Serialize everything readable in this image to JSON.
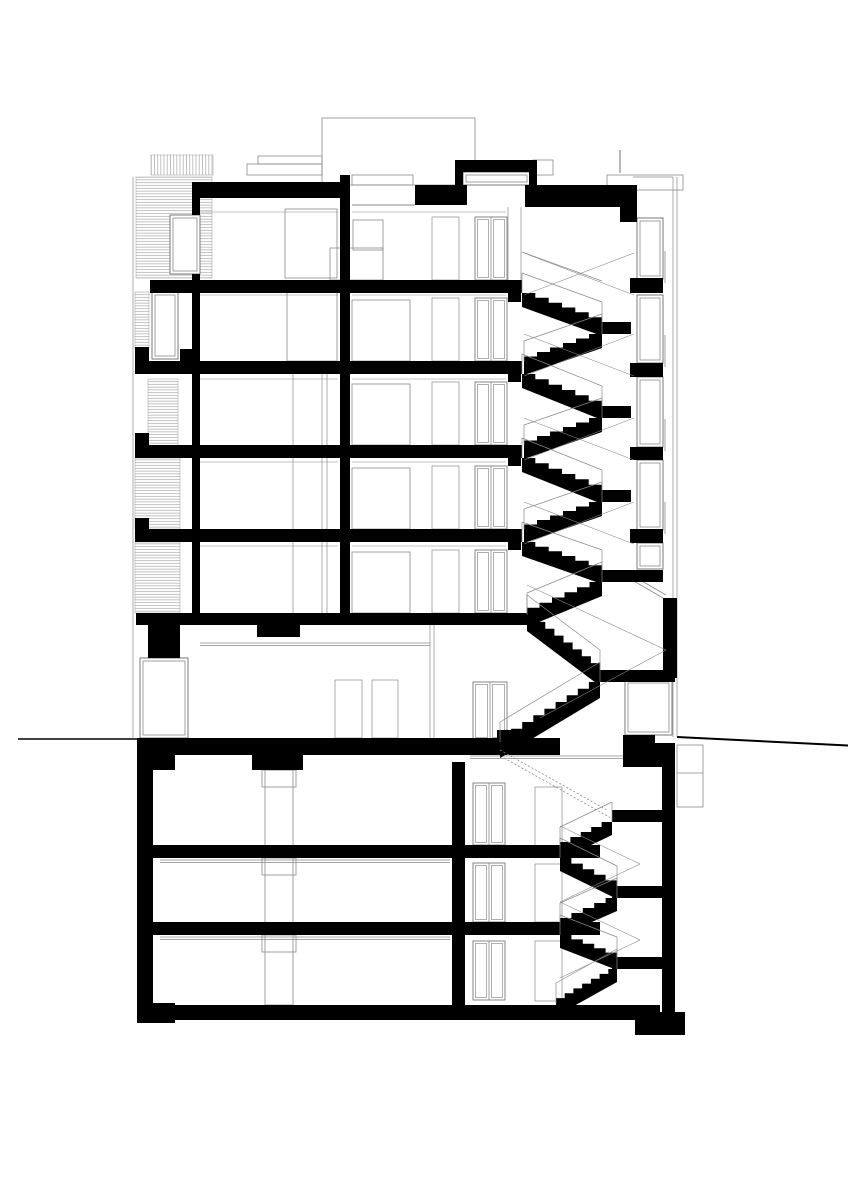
{
  "document": {
    "kind": "architectural-section-drawing",
    "canvas": {
      "width": 848,
      "height": 1200
    },
    "colors": {
      "background": "#ffffff",
      "ink": "#000000",
      "thin_line": "#8a8a8a",
      "frame_line": "#7a7a7a",
      "hatch_line": "#9b9b9b"
    }
  },
  "drawing": {
    "blacks": [
      [
        192,
        182,
        155,
        16
      ],
      [
        340,
        175,
        10,
        50
      ],
      [
        415,
        185,
        52,
        20
      ],
      [
        455,
        160,
        82,
        12
      ],
      [
        455,
        172,
        8,
        13
      ],
      [
        529,
        172,
        8,
        13
      ],
      [
        525,
        185,
        112,
        22
      ],
      [
        620,
        207,
        17,
        15
      ],
      [
        192,
        198,
        8,
        17
      ],
      [
        192,
        274,
        8,
        339
      ],
      [
        340,
        198,
        10,
        415
      ],
      [
        508,
        280,
        13,
        22
      ],
      [
        508,
        361,
        13,
        21
      ],
      [
        508,
        445,
        13,
        21
      ],
      [
        508,
        529,
        13,
        21
      ],
      [
        150,
        280,
        372,
        13
      ],
      [
        143,
        361,
        379,
        13
      ],
      [
        143,
        445,
        379,
        13
      ],
      [
        143,
        529,
        379,
        13
      ],
      [
        135,
        347,
        14,
        27
      ],
      [
        180,
        349,
        16,
        25
      ],
      [
        135,
        433,
        14,
        25
      ],
      [
        135,
        518,
        14,
        24
      ],
      [
        136,
        613,
        391,
        12
      ],
      [
        257,
        625,
        43,
        12
      ],
      [
        148,
        625,
        32,
        33
      ],
      [
        630,
        278,
        33,
        15
      ],
      [
        630,
        363,
        33,
        14
      ],
      [
        630,
        447,
        33,
        13
      ],
      [
        630,
        529,
        33,
        14
      ],
      [
        663,
        598,
        14,
        80
      ],
      [
        623,
        735,
        32,
        15
      ],
      [
        653,
        750,
        20,
        17
      ],
      [
        137,
        738,
        423,
        17
      ],
      [
        137,
        740,
        38,
        30
      ],
      [
        623,
        743,
        52,
        24
      ],
      [
        497,
        730,
        30,
        10
      ],
      [
        137,
        755,
        16,
        250
      ],
      [
        137,
        1003,
        38,
        20
      ],
      [
        153,
        845,
        447,
        13
      ],
      [
        153,
        922,
        447,
        13
      ],
      [
        137,
        1005,
        523,
        15
      ],
      [
        452,
        762,
        13,
        243
      ],
      [
        252,
        755,
        51,
        15
      ],
      [
        662,
        755,
        13,
        257
      ],
      [
        635,
        1012,
        50,
        23
      ]
    ],
    "hatches_h": [
      [
        136,
        177,
        76,
        101
      ],
      [
        135,
        292,
        14,
        57
      ],
      [
        148,
        379,
        30,
        67
      ],
      [
        135,
        458,
        45,
        71
      ],
      [
        135,
        542,
        45,
        71
      ]
    ],
    "hatches_v": [
      [
        151,
        155,
        62,
        20
      ]
    ],
    "thin_rects": [
      [
        322,
        118,
        153,
        67
      ],
      [
        352,
        175,
        61,
        10
      ],
      [
        247,
        164,
        75,
        11
      ],
      [
        258,
        156,
        64,
        8
      ],
      [
        533,
        160,
        20,
        15
      ],
      [
        607,
        175,
        76,
        15
      ],
      [
        677,
        745,
        26,
        62
      ],
      [
        285,
        209,
        52,
        69
      ],
      [
        287,
        292,
        50,
        69
      ],
      [
        353,
        220,
        30,
        30
      ],
      [
        330,
        248,
        53,
        32
      ],
      [
        352,
        300,
        58,
        61
      ],
      [
        352,
        384,
        58,
        61
      ],
      [
        352,
        468,
        58,
        61
      ],
      [
        352,
        552,
        58,
        61
      ],
      [
        262,
        770,
        34,
        17
      ],
      [
        262,
        858,
        34,
        17
      ],
      [
        262,
        935,
        34,
        17
      ],
      [
        265,
        770,
        28,
        235
      ]
    ],
    "windows": [
      [
        170,
        215,
        30,
        59
      ],
      [
        152,
        292,
        26,
        67
      ],
      [
        637,
        218,
        26,
        61
      ],
      [
        637,
        295,
        26,
        68
      ],
      [
        637,
        377,
        26,
        70
      ],
      [
        637,
        460,
        26,
        70
      ],
      [
        637,
        543,
        26,
        26
      ],
      [
        463,
        172,
        67,
        13
      ],
      [
        140,
        658,
        48,
        80
      ],
      [
        625,
        680,
        47,
        55
      ]
    ],
    "framed_doors": [
      [
        475,
        217,
        32,
        63
      ],
      [
        475,
        298,
        32,
        63
      ],
      [
        475,
        382,
        32,
        63
      ],
      [
        475,
        466,
        32,
        63
      ],
      [
        475,
        550,
        32,
        63
      ],
      [
        473,
        682,
        34,
        58
      ],
      [
        473,
        783,
        32,
        62
      ],
      [
        473,
        863,
        32,
        59
      ],
      [
        473,
        941,
        32,
        59
      ]
    ],
    "thin_doors": [
      [
        432,
        217,
        27,
        63
      ],
      [
        432,
        298,
        27,
        63
      ],
      [
        432,
        382,
        27,
        63
      ],
      [
        432,
        466,
        27,
        63
      ],
      [
        432,
        550,
        27,
        63
      ],
      [
        335,
        680,
        27,
        58
      ],
      [
        372,
        680,
        26,
        58
      ],
      [
        535,
        787,
        27,
        60
      ],
      [
        535,
        864,
        27,
        58
      ],
      [
        535,
        941,
        27,
        60
      ]
    ],
    "flights": [
      [
        522,
        293,
        602,
        322,
        6,
        14
      ],
      [
        602,
        334,
        524,
        361,
        6,
        14
      ],
      [
        522,
        374,
        602,
        406,
        6,
        14
      ],
      [
        602,
        418,
        524,
        445,
        6,
        14
      ],
      [
        522,
        458,
        602,
        490,
        6,
        14
      ],
      [
        602,
        502,
        524,
        529,
        6,
        14
      ],
      [
        522,
        542,
        602,
        570,
        6,
        14
      ],
      [
        602,
        582,
        527,
        613,
        6,
        14
      ],
      [
        527,
        615,
        600,
        670,
        8,
        16
      ],
      [
        600,
        682,
        500,
        742,
        9,
        16
      ],
      [
        612,
        822,
        560,
        847,
        5,
        13
      ],
      [
        560,
        858,
        617,
        886,
        5,
        13
      ],
      [
        617,
        898,
        560,
        923,
        5,
        13
      ],
      [
        560,
        935,
        617,
        957,
        5,
        13
      ],
      [
        617,
        969,
        556,
        1003,
        7,
        13
      ]
    ],
    "landings": [
      [
        598,
        322,
        33,
        12
      ],
      [
        598,
        406,
        33,
        12
      ],
      [
        598,
        490,
        33,
        12
      ],
      [
        600,
        570,
        63,
        12
      ],
      [
        598,
        670,
        77,
        12
      ],
      [
        612,
        810,
        50,
        12
      ],
      [
        612,
        886,
        50,
        12
      ],
      [
        612,
        957,
        50,
        12
      ]
    ],
    "stringers": [
      [
        524,
        253,
        634,
        295
      ],
      [
        524,
        295,
        634,
        253
      ],
      [
        524,
        334,
        634,
        376
      ],
      [
        524,
        376,
        634,
        334
      ],
      [
        524,
        418,
        634,
        460
      ],
      [
        524,
        460,
        634,
        418
      ],
      [
        524,
        502,
        634,
        544
      ],
      [
        524,
        544,
        634,
        502
      ],
      [
        527,
        585,
        666,
        650
      ],
      [
        666,
        650,
        540,
        718
      ],
      [
        560,
        826,
        640,
        864
      ],
      [
        640,
        864,
        560,
        902
      ],
      [
        560,
        902,
        640,
        940
      ],
      [
        640,
        940,
        560,
        978
      ]
    ],
    "dashed_flights": [
      [
        500,
        750,
        607,
        810
      ],
      [
        504,
        758,
        611,
        818
      ]
    ],
    "lines": [
      [
        673,
        177,
        673,
        737,
        0.7
      ],
      [
        677,
        177,
        677,
        737,
        0.7
      ],
      [
        633,
        177,
        673,
        177,
        0.7
      ],
      [
        620,
        150,
        620,
        173,
        1.2
      ],
      [
        196,
        212,
        338,
        212,
        0.6
      ],
      [
        352,
        212,
        506,
        212,
        0.6
      ],
      [
        196,
        295,
        338,
        295,
        0.6
      ],
      [
        352,
        295,
        506,
        295,
        0.6
      ],
      [
        196,
        379,
        338,
        379,
        0.6
      ],
      [
        352,
        379,
        506,
        379,
        0.6
      ],
      [
        196,
        462,
        338,
        462,
        0.6
      ],
      [
        352,
        462,
        506,
        462,
        0.6
      ],
      [
        196,
        546,
        338,
        546,
        0.6
      ],
      [
        352,
        546,
        506,
        546,
        0.6
      ],
      [
        200,
        643,
        430,
        643,
        0.8
      ],
      [
        200,
        645.5,
        430,
        645.5,
        0.8
      ],
      [
        160,
        860,
        450,
        860,
        0.7
      ],
      [
        160,
        862.5,
        450,
        862.5,
        0.7
      ],
      [
        160,
        937,
        450,
        937,
        0.7
      ],
      [
        160,
        939.5,
        450,
        939.5,
        0.7
      ],
      [
        470,
        756,
        655,
        756,
        0.7
      ],
      [
        470,
        758.5,
        655,
        758.5,
        0.7
      ],
      [
        293,
        374,
        293,
        445,
        0.7
      ],
      [
        322,
        374,
        322,
        445,
        0.7
      ],
      [
        327,
        374,
        327,
        445,
        0.7
      ],
      [
        293,
        458,
        293,
        529,
        0.7
      ],
      [
        322,
        458,
        322,
        529,
        0.7
      ],
      [
        327,
        458,
        327,
        529,
        0.7
      ],
      [
        293,
        542,
        293,
        613,
        0.7
      ],
      [
        322,
        542,
        322,
        613,
        0.7
      ],
      [
        327,
        542,
        327,
        613,
        0.7
      ],
      [
        430,
        625,
        430,
        738,
        0.7
      ],
      [
        434,
        625,
        434,
        738,
        0.7
      ],
      [
        665,
        251,
        665,
        283,
        0.8
      ],
      [
        665,
        335,
        665,
        367,
        0.8
      ],
      [
        665,
        419,
        665,
        451,
        0.8
      ],
      [
        665,
        502,
        665,
        534,
        0.8
      ],
      [
        632,
        580,
        663,
        598,
        0.9
      ],
      [
        635,
        577,
        666,
        595,
        0.9
      ],
      [
        133,
        177,
        133,
        738,
        0.7
      ],
      [
        352,
        205,
        415,
        205,
        1.0
      ],
      [
        508,
        207,
        508,
        280,
        0.7
      ],
      [
        521,
        207,
        521,
        280,
        0.7
      ],
      [
        522,
        252,
        602,
        281,
        0.7
      ],
      [
        677,
        773,
        703,
        773,
        0.7
      ]
    ],
    "ground_lines": [
      [
        18,
        739,
        137,
        739,
        1.6
      ],
      [
        677,
        737,
        848,
        745.5,
        2.0
      ]
    ]
  }
}
